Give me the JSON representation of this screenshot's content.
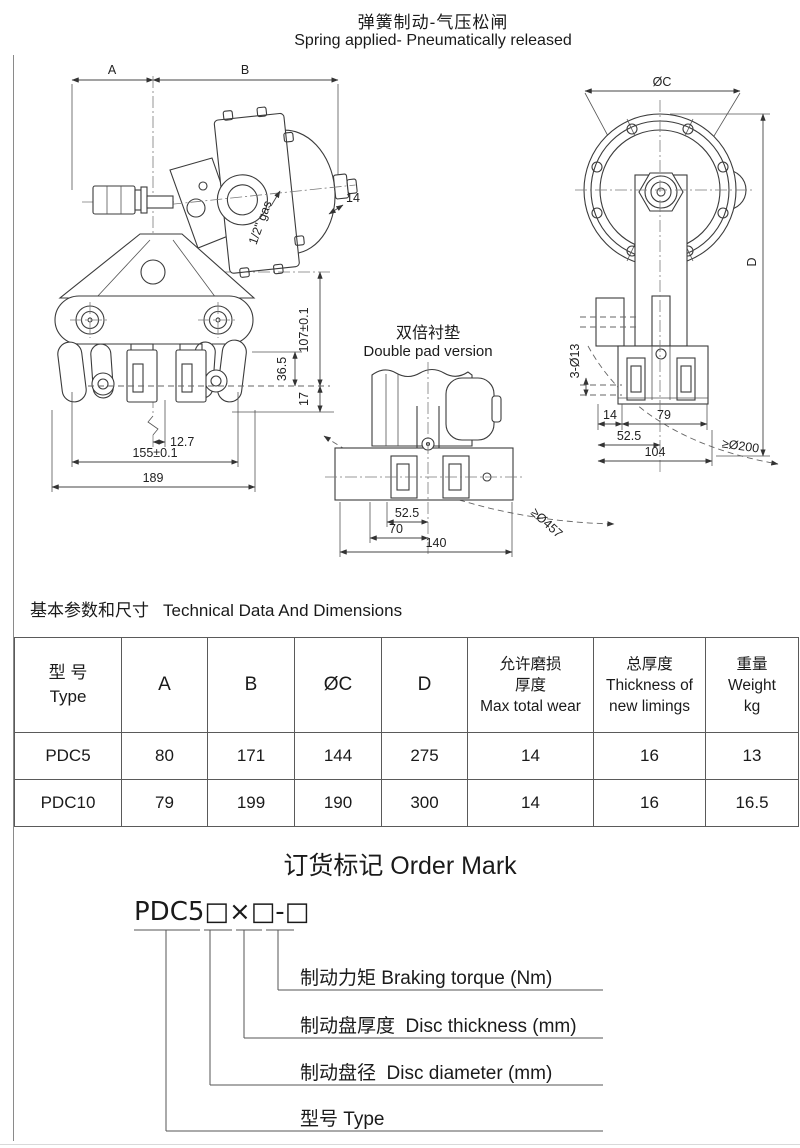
{
  "page_title": {
    "zh": "弹簧制动-气压松闸",
    "en": "Spring applied- Pneumatically released"
  },
  "drawings": {
    "side_view": {
      "dim_a": "A",
      "dim_b": "B",
      "dim_14": "14",
      "dim_gas": "1/2\" gas",
      "dim_107": "107±0.1",
      "dim_36_5": "36.5",
      "dim_17": "17",
      "dim_12_7": "12.7",
      "dim_155": "155±0.1",
      "dim_189": "189"
    },
    "double_pad": {
      "title_zh": "双倍衬垫",
      "title_en": "Double pad version",
      "dim_52_5": "52.5",
      "dim_70": "70",
      "dim_140": "140",
      "dim_disc": "≥Ø457"
    },
    "front_view": {
      "dim_c": "ØC",
      "dim_d": "D",
      "dim_holes": "3-Ø13",
      "dim_14": "14",
      "dim_79": "79",
      "dim_52_5": "52.5",
      "dim_104": "104",
      "dim_disc": "≥Ø200"
    }
  },
  "section_heading": {
    "zh": "基本参数和尺寸",
    "en": "Technical Data And Dimensions"
  },
  "table": {
    "col_type": {
      "zh": "型 号",
      "en": "Type"
    },
    "col_a": "A",
    "col_b": "B",
    "col_c": "ØC",
    "col_d": "D",
    "col_wear": {
      "zh1": "允许磨损",
      "zh2": "厚度",
      "en": "Max total wear"
    },
    "col_new": {
      "zh": "总厚度",
      "en1": "Thickness of",
      "en2": "new limings"
    },
    "col_weight": {
      "zh": "重量",
      "en": "Weight",
      "unit": "kg"
    },
    "rows": [
      {
        "type": "PDC5",
        "a": "80",
        "b": "171",
        "c": "144",
        "d": "275",
        "wear": "14",
        "new_lining": "16",
        "weight": "13"
      },
      {
        "type": "PDC10",
        "a": "79",
        "b": "199",
        "c": "190",
        "d": "300",
        "wear": "14",
        "new_lining": "16",
        "weight": "16.5"
      }
    ]
  },
  "order_mark": {
    "heading": "订货标记 Order Mark",
    "code": "PDC5□×□-□",
    "labels": [
      "制动力矩 Braking torque (Nm)",
      "制动盘厚度  Disc thickness (mm)",
      "制动盘径  Disc diameter (mm)",
      "型号 Type"
    ]
  }
}
